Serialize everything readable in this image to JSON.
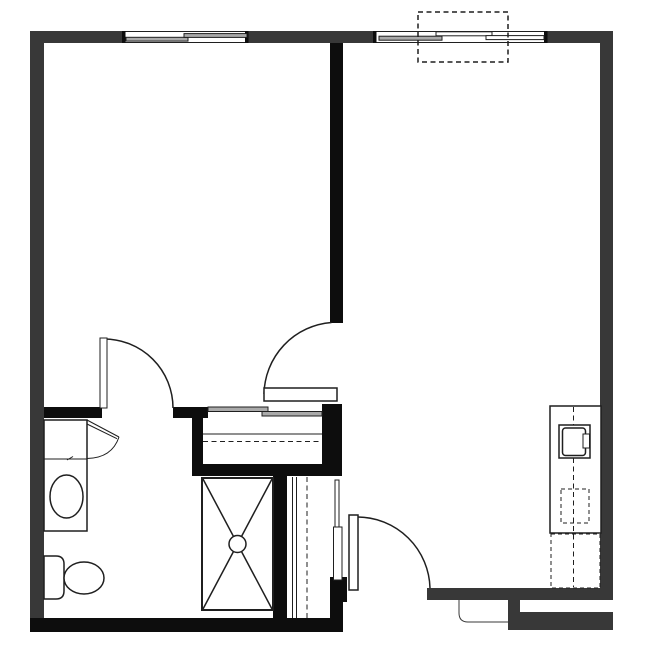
{
  "page": {
    "title": "one-bedroom-unit-floor-plan",
    "visible_text": []
  },
  "colors": {
    "background": "#ffffff",
    "exterior_wall": "#383838",
    "interior_wall": "#0d0d0d",
    "line": "#1f1f1f",
    "panel_fill": "#aaaaaa"
  },
  "features": [
    {
      "name": "top-window-bedroom",
      "symbol": "sliding-window"
    },
    {
      "name": "top-window-living",
      "symbol": "sliding-window"
    },
    {
      "name": "overhead-unit",
      "symbol": "dashed-rectangle-overlay"
    },
    {
      "name": "bathroom-door",
      "symbol": "swing-door-arc"
    },
    {
      "name": "hall-door",
      "symbol": "swing-door-arc"
    },
    {
      "name": "entry-door",
      "symbol": "swing-door-arc"
    },
    {
      "name": "bedroom-closet",
      "symbol": "bypass-sliders-shelf-and-rod"
    },
    {
      "name": "linen-closet",
      "symbol": "shelf-and-rod-lines"
    },
    {
      "name": "shower-pan",
      "symbol": "x-box-with-drain-circle"
    },
    {
      "name": "vanity-sink",
      "symbol": "oval-basin-counter"
    },
    {
      "name": "toilet",
      "symbol": "tank-and-bowl"
    },
    {
      "name": "kitchen-counter",
      "symbol": "counter-with-centerline"
    },
    {
      "name": "kitchen-sink",
      "symbol": "square-basin-with-faucet"
    },
    {
      "name": "dishwasher",
      "symbol": "dashed-undercounter-box"
    },
    {
      "name": "refrigerator",
      "symbol": "dashed-box"
    },
    {
      "name": "entry-niche",
      "symbol": "recessed-notch"
    }
  ]
}
